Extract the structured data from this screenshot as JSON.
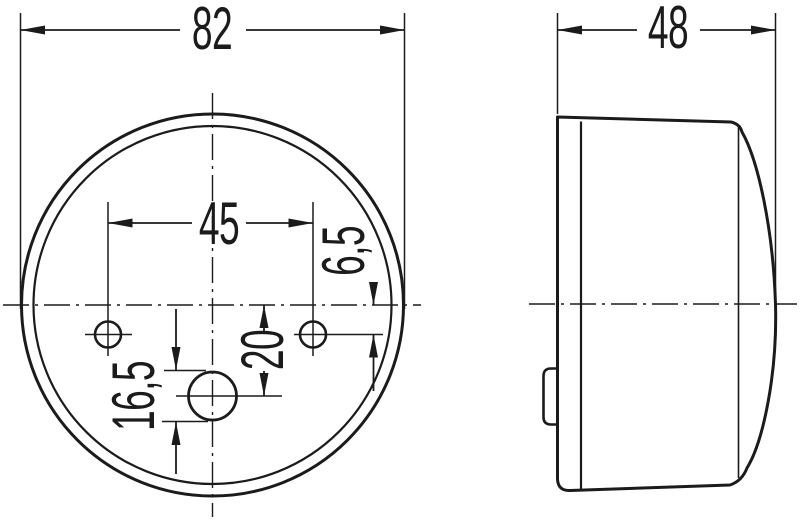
{
  "title": "Technical drawing of round lamp: front view and side view",
  "colors": {
    "line": "#1b1b1b",
    "background": "#ffffff"
  },
  "front_view": {
    "outer_diameter_label": "82",
    "hole_spacing_label": "45",
    "hole_offset_label": "6,5",
    "center_hole_offset_label": "20",
    "center_hole_diameter_label": "16,5"
  },
  "side_view": {
    "depth_label": "48"
  }
}
